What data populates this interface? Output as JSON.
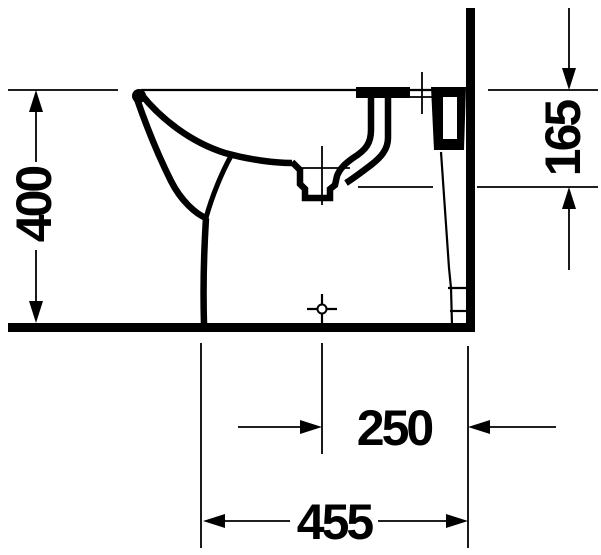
{
  "diagram": {
    "subject": "Floor-standing bidet, side elevation against wall with floor line",
    "style": "black line technical drawing on white",
    "colors": {
      "line": "#000000",
      "background": "#ffffff"
    },
    "dimensions": {
      "height": {
        "label": "400",
        "orientation": "vertical",
        "measures": "floor to rim top"
      },
      "rim_to_inlet": {
        "label": "165",
        "orientation": "vertical",
        "measures": "rim top down to inlet level at wall side"
      },
      "drain_center_to_wall": {
        "label": "250",
        "orientation": "horizontal",
        "measures": "drain centerline to wall"
      },
      "depth": {
        "label": "455",
        "orientation": "horizontal",
        "measures": "front edge to wall"
      }
    },
    "symbols": {
      "tap_hole_centerline": "crosshair on rear deck",
      "drain_centerline": "crosshair at drain recess",
      "floor_fixing_point": "small circle with crosshair at floor"
    }
  }
}
